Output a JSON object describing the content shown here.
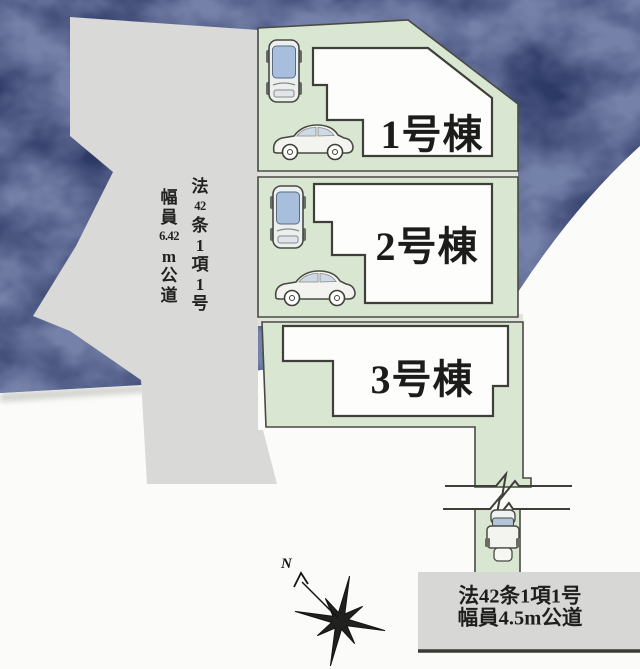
{
  "title": "分譲地 区画図 (site plan)",
  "plots": {
    "buildings": [
      {
        "label": "1号棟"
      },
      {
        "label": "2号棟"
      },
      {
        "label": "3号棟"
      }
    ]
  },
  "roads": {
    "west_road": {
      "full_text": "法42条1項1号 幅員6.42m公道",
      "col_right": [
        "法",
        "42",
        "条",
        "1",
        "項",
        "1",
        "号"
      ],
      "col_left": [
        "幅",
        "員",
        "6.42",
        "m",
        "公",
        "道"
      ]
    },
    "south_road": {
      "line1": "法42条1項1号",
      "line2": "幅員4.5m公道"
    }
  },
  "compass": {
    "north_label": "N"
  },
  "colors": {
    "background": "#fbfbf9",
    "terrain_blob": "#2e3a66",
    "plot_green": "#d9e7d2",
    "road_gray": "#d9d9d7",
    "outline": "#3f3f39",
    "building_fill": "#fdfdfb",
    "car_window_blue": "#a7bedd"
  }
}
